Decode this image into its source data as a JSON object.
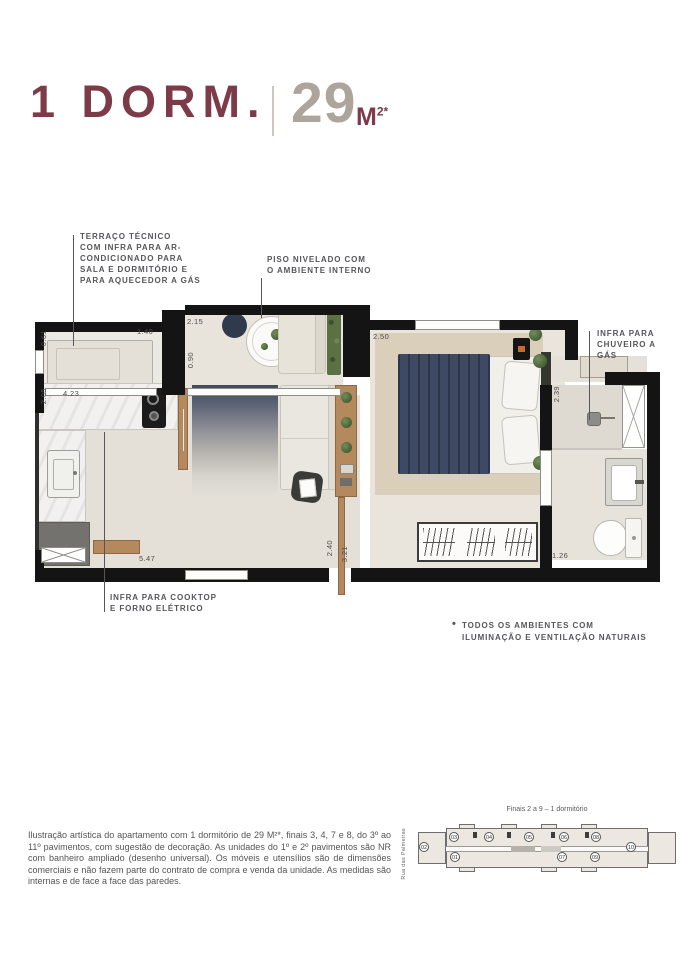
{
  "colors": {
    "accent_maroon": "#7d3b4a",
    "area_gray": "#ada59c",
    "wall_black": "#141414",
    "annotation_gray": "#55565a",
    "floor_beige": "#e7e3db",
    "rug_navy": "#3e4a63",
    "wood": "#b4895e",
    "plant_green": "#4e6a3e"
  },
  "header": {
    "title": "1 DORM.",
    "area_number": "29",
    "area_unit": "M",
    "area_sup": "2*"
  },
  "callouts": {
    "terraco": {
      "lines": [
        "TERRAÇO TÉCNICO",
        "COM INFRA PARA AR-",
        "CONDICIONADO PARA",
        "SALA E DORMITÓRIO E",
        "PARA AQUECEDOR A GÁS"
      ]
    },
    "piso": {
      "lines": [
        "PISO NIVELADO COM",
        "O AMBIENTE INTERNO"
      ]
    },
    "chuveiro": {
      "lines": [
        "INFRA PARA",
        "CHUVEIRO A",
        "GÁS"
      ]
    },
    "cooktop": {
      "lines": [
        "INFRA PARA COOKTOP",
        "E FORNO ELÉTRICO"
      ]
    }
  },
  "note": {
    "bullet": "•",
    "lines": [
      "TODOS OS AMBIENTES COM",
      "ILUMINAÇÃO E VENTILAÇÃO NATURAIS"
    ]
  },
  "dims": {
    "terrace_h": "0.61",
    "terrace_w": "1.40",
    "varanda_w": "2.15",
    "varanda_h": "0.90",
    "bedroom_w": "2.50",
    "kitchen_h": "2.05",
    "kitchen_w": "4.23",
    "bath_h": "2.39",
    "living_w": "5.47",
    "hall_h1": "2.40",
    "hall_h2": "3.21",
    "bath_w": "1.26"
  },
  "disclaimer": "Ilustração artística do apartamento com 1 dormitório de 29 M²*, finais 3, 4, 7 e 8, do 3º ao 11º pavimentos, com sugestão de decoração. As unidades do 1º e 2º pavimentos são NR com banheiro ampliado (desenho universal). Os móveis e utensílios são de dimensões comerciais e não fazem parte do contrato de compra e venda da unidade. As medidas são internas e de face a face das paredes.",
  "keyplan": {
    "caption": "Finais 2 a 9 – 1 dormitório",
    "street": "Rua das Palmeiras",
    "units": [
      "02",
      "03",
      "04",
      "05",
      "06",
      "08",
      "01",
      "07",
      "09",
      "10"
    ]
  }
}
